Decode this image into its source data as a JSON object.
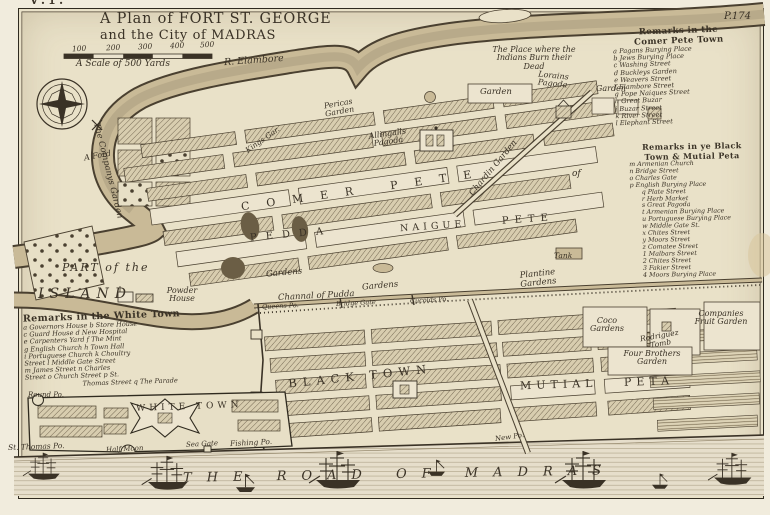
{
  "page": {
    "volume": "V.I.",
    "plate": "P.174"
  },
  "title": {
    "line1": "A Plan of FORT ST. GEORGE",
    "line2": "and the City of MADRAS"
  },
  "scale": {
    "ticks": [
      "100",
      "200",
      "300",
      "400",
      "500"
    ],
    "caption": "A Scale of 500 Yards"
  },
  "colors": {
    "paper": "#e9e1c8",
    "ink": "#3a3226",
    "water": "#c9ba97"
  },
  "map_labels": {
    "river": "R. Elambore",
    "companys_garden": "The Companys Garden",
    "ford": "A Ford",
    "pericas_garden": "Pericas Garden",
    "kings_garden": "Kings Gar.",
    "allingalls_pagoda": "Allingalls Pagoda",
    "burn_place": "The Place where the Indians Burn their Dead",
    "lorains_pagoda": "Lorains Pagoda",
    "garden_west": "Garden",
    "garden_east": "Garden",
    "chardin_garden": "Chardin Garden",
    "comer_pete": "COMER PETE",
    "of": "of",
    "pedda": "PEDDA",
    "naigue": "NAIGUE",
    "pete": "PETE",
    "gardens_west": "Gardens",
    "gardens_center": "Gardens",
    "tank": "Tank",
    "plantine_gardens": "Plantine Gardens",
    "channel": "Channal of Pudda",
    "queens_point": "Queens Po.",
    "bridge_gate": "Bridge Gate",
    "cucolds_point": "Cucolds Po.",
    "black_town": "BLACK TOWN",
    "mutial": "MUTIAL",
    "peta": "PETA",
    "new_point": "New Po.",
    "coco_gardens": "Coco Gardens",
    "rodriguez_tomb": "Rodriguez Tomb",
    "four_brothers_garden": "Four Brothers Garden",
    "companies_fruit_garden": "Companies Fruit Garden",
    "part_of_the": "PART of the",
    "island": "ISLAND",
    "powder_house": "Powder House",
    "white_town": "WHITE TOWN",
    "round_point": "Round Po.",
    "st_thomas_point": "St. Thomas Po.",
    "half_moon": "Half Moon",
    "sea_gate": "Sea Gate",
    "fishing_point": "Fishing Po.",
    "road_of_madras": "THE ROAD OF MADRAS"
  },
  "remarks_comer_pete": {
    "title_line1": "Remarks in the",
    "title_line2": "Comer Pete Town",
    "items": [
      "a Pagans Burying Place",
      "b Jews Burying Place",
      "c Washing Street",
      "d Buckleys Garden",
      "e Weavers Street",
      "f Elambore Street",
      "g Pope Naiques Street",
      "h Great Buzar",
      "i Buzar Street",
      "k River Street",
      "l Elephant Street"
    ]
  },
  "remarks_black_town": {
    "title_line1": "Remarks in ye Black",
    "title_line2": "Town & Mutial Peta",
    "items": [
      "m Armenian Church",
      "n Bridge Street",
      "o Charles Gate",
      "p English Burying Place",
      "q Plate Street",
      "r Herb Market",
      "s Great Pagoda",
      "t Armenian Burying Place",
      "u Portuguese Burying Place",
      "w Middle Gate St.",
      "x Chites Street",
      "y Moors Street",
      "z Comatee Street",
      "1 Malbars Street",
      "2 Chites Street",
      "3 Fakier Street",
      "4 Moors Burying Place"
    ]
  },
  "remarks_white_town": {
    "title": "Remarks in the White Town",
    "lines": [
      "a Governors House b Store House",
      "c Guard House d New Hospital",
      "e Carpenters Yard f The Mint",
      "g English Church h Town Hall",
      "i Portuguese Church k Choultry",
      "Street l Middle Gate Street",
      "m James Street n Charles",
      "Street o Church Street p St.",
      "Thomas Street q The Parade"
    ]
  }
}
